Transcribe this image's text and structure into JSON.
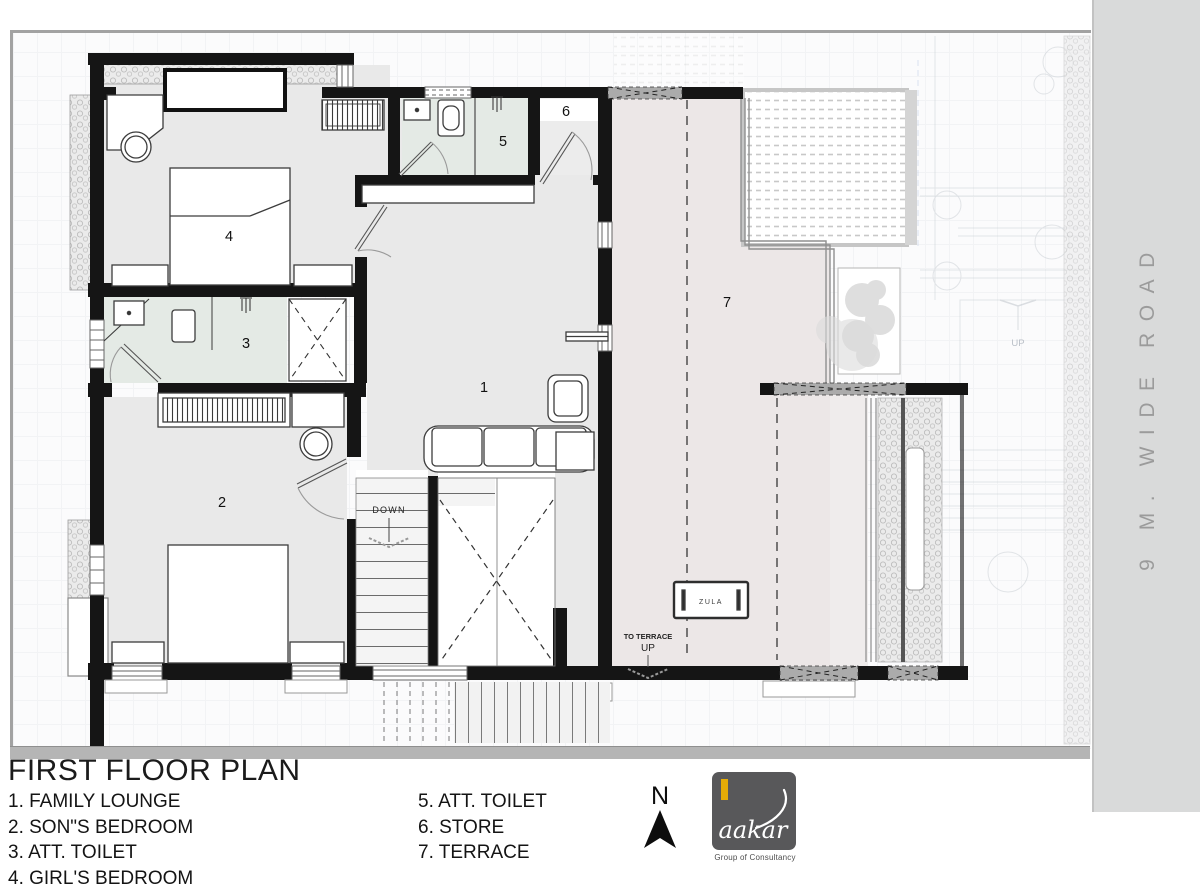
{
  "title": "FIRST FLOOR PLAN",
  "legend": {
    "column1": [
      "1. FAMILY LOUNGE",
      "2. SON\"S BEDROOM",
      "3. ATT. TOILET",
      "4. GIRL'S BEDROOM"
    ],
    "column2": [
      "5. ATT. TOILET",
      "6. STORE",
      "7. TERRACE"
    ]
  },
  "plan_labels": {
    "rooms": [
      "1",
      "2",
      "3",
      "4",
      "5",
      "6",
      "7"
    ],
    "down": "DOWN",
    "to_terrace_line1": "TO TERRACE",
    "to_terrace_line2": "UP",
    "zula": "ZULA",
    "site_up": "UP"
  },
  "north_indicator": {
    "label": "N"
  },
  "logo": {
    "brand": "aakar",
    "tagline": "Group of Consultancy",
    "colors": {
      "background": "#58585a",
      "accent_bar": "#e5ac07",
      "text": "#ffffff"
    }
  },
  "road_label": "9 M. WIDE ROAD",
  "colors": {
    "wall": "#151515",
    "bedroom_floor": "#e9e9e9",
    "toilet_floor": "#e4eae5",
    "terrace_floor": "#ece7e7",
    "parapet_hatch": "#ababab",
    "road_strip": "#d9dada",
    "sheet_border": "#a2a2a2"
  }
}
